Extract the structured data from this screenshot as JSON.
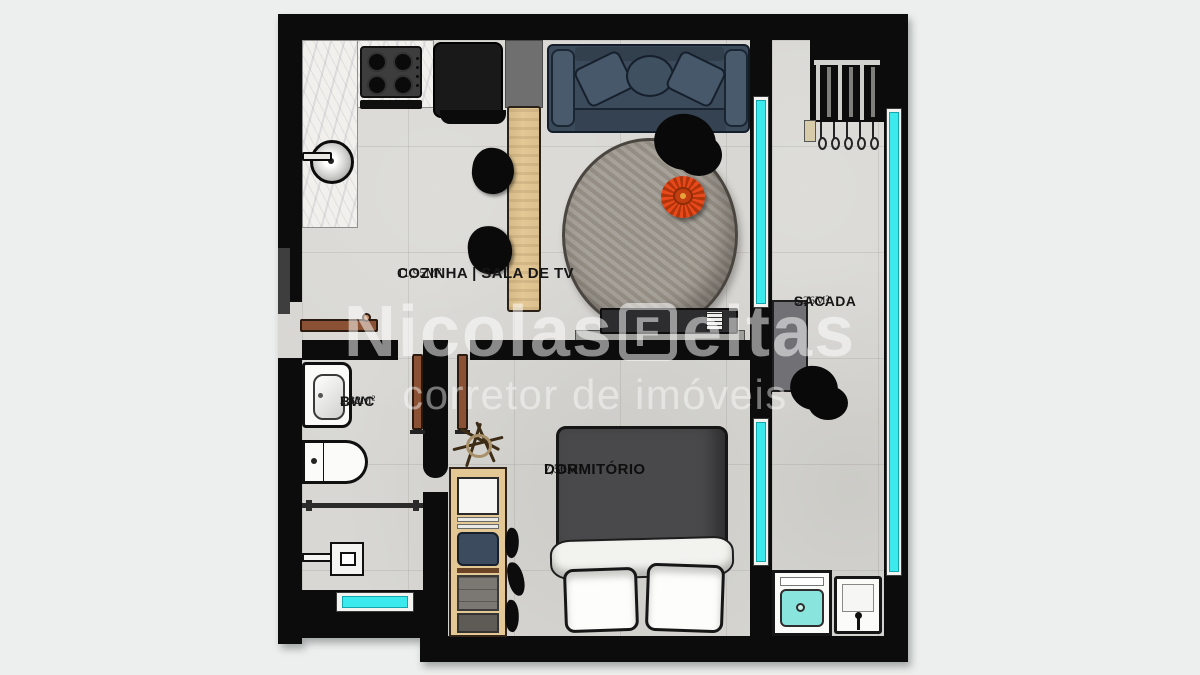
{
  "watermark": {
    "brand_left": "Nicolas",
    "logo_letter": "F",
    "brand_right": "eitas",
    "tagline": "corretor de imóveis"
  },
  "rooms": {
    "cozinha": {
      "name": "COZINHA | SALA DE TV",
      "area": "11,95M²"
    },
    "sacada": {
      "name": "SACADA",
      "area": "6,26M²"
    },
    "bwc": {
      "name": "BWC",
      "area": "2,82M²"
    },
    "dormitorio": {
      "name": "DORMITÓRIO",
      "area": "7,56M²"
    }
  },
  "colors": {
    "wall": "#0c0c0c",
    "floor": "#d8d7d3",
    "window": "#3ce9ec",
    "sofa": "#3c4b5b",
    "wood": "#e3c896",
    "accent_red": "#e8491c"
  }
}
